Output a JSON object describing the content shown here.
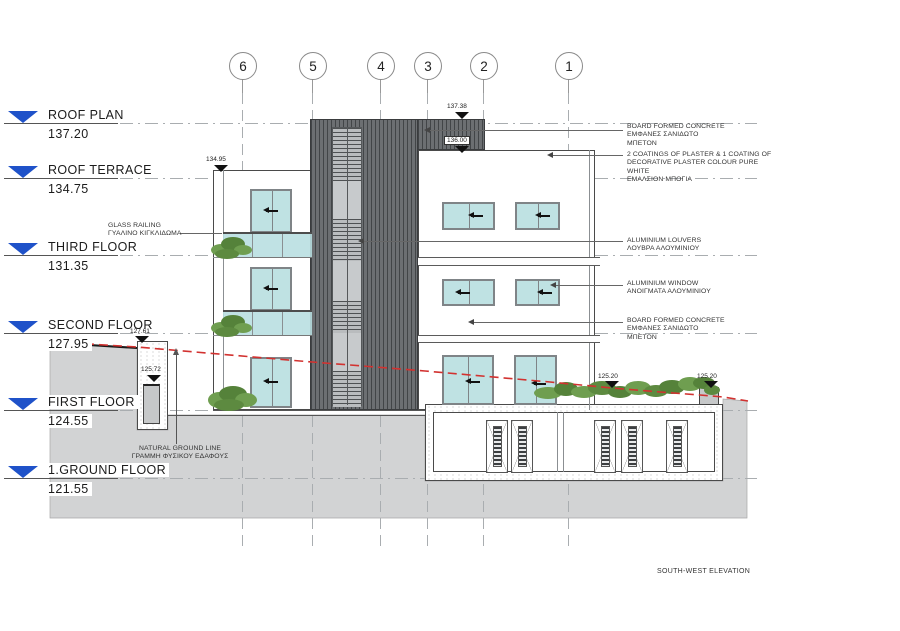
{
  "title": "SOUTH-WEST ELEVATION",
  "grid_bubbles": [
    "6",
    "5",
    "4",
    "3",
    "2",
    "1"
  ],
  "floor_levels": [
    {
      "label": "ROOF PLAN",
      "value": "137.20"
    },
    {
      "label": "ROOF TERRACE",
      "value": "134.75"
    },
    {
      "label": "THIRD FLOOR",
      "value": "131.35"
    },
    {
      "label": "SECOND FLOOR",
      "value": "127.95"
    },
    {
      "label": "FIRST FLOOR",
      "value": "124.55"
    },
    {
      "label": "1.GROUND FLOOR",
      "value": "121.55"
    }
  ],
  "spot_elevations": [
    "137.38",
    "136.00",
    "134.95",
    "127.61",
    "125.72",
    "125.20",
    "125.20"
  ],
  "annotations_right": [
    {
      "lines": [
        "BOARD FORMED CONCRETE",
        "ΕΜΦΑΝΕΣ ΣΑΝΙΔΩΤΟ",
        "ΜΠΕΤΟΝ"
      ]
    },
    {
      "lines": [
        "2 COATINGS OF PLASTER & 1 COATING OF",
        "DECORATIVE PLASTER COLOUR PURE",
        "WHITE",
        "ΕΜΑΛΣΙΟΝ ΜΠΟΓΙΑ"
      ]
    },
    {
      "lines": [
        "ALUMINIUM LOUVERS",
        "ΛΟΥΒΡΑ ΑΛΟΥΜΙΝΙΟΥ"
      ]
    },
    {
      "lines": [
        "ALUMINIUM WINDOW",
        "ΑΝΟΙΓΜΑΤΑ ΑΛΟΥΜΙΝΙΟΥ"
      ]
    },
    {
      "lines": [
        "BOARD FORMED CONCRETE",
        "ΕΜΦΑΝΕΣ ΣΑΝΙΔΩΤΟ",
        "ΜΠΕΤΟΝ"
      ]
    }
  ],
  "annotations_left": [
    {
      "lines": [
        "GLASS RAILING",
        "ΓΥΑΛΙΝΟ ΚΙΓΚΛΙΔΩΜΑ"
      ]
    },
    {
      "lines": [
        "NATURAL GROUND LINE",
        "ΓΡΑΜΜΗ ΦΥΣΙΚΟΥ ΕΔΑΦΟΥΣ"
      ]
    }
  ],
  "colors": {
    "window_glass": "#bfe2e3",
    "tower_louvers_dark": "#6c6f72",
    "ground_fill": "#d2d3d4",
    "natural_ground_line_red": "#d23230",
    "vegetation_green": "#6f9e50",
    "level_marker_blue": "#1f52c9"
  }
}
